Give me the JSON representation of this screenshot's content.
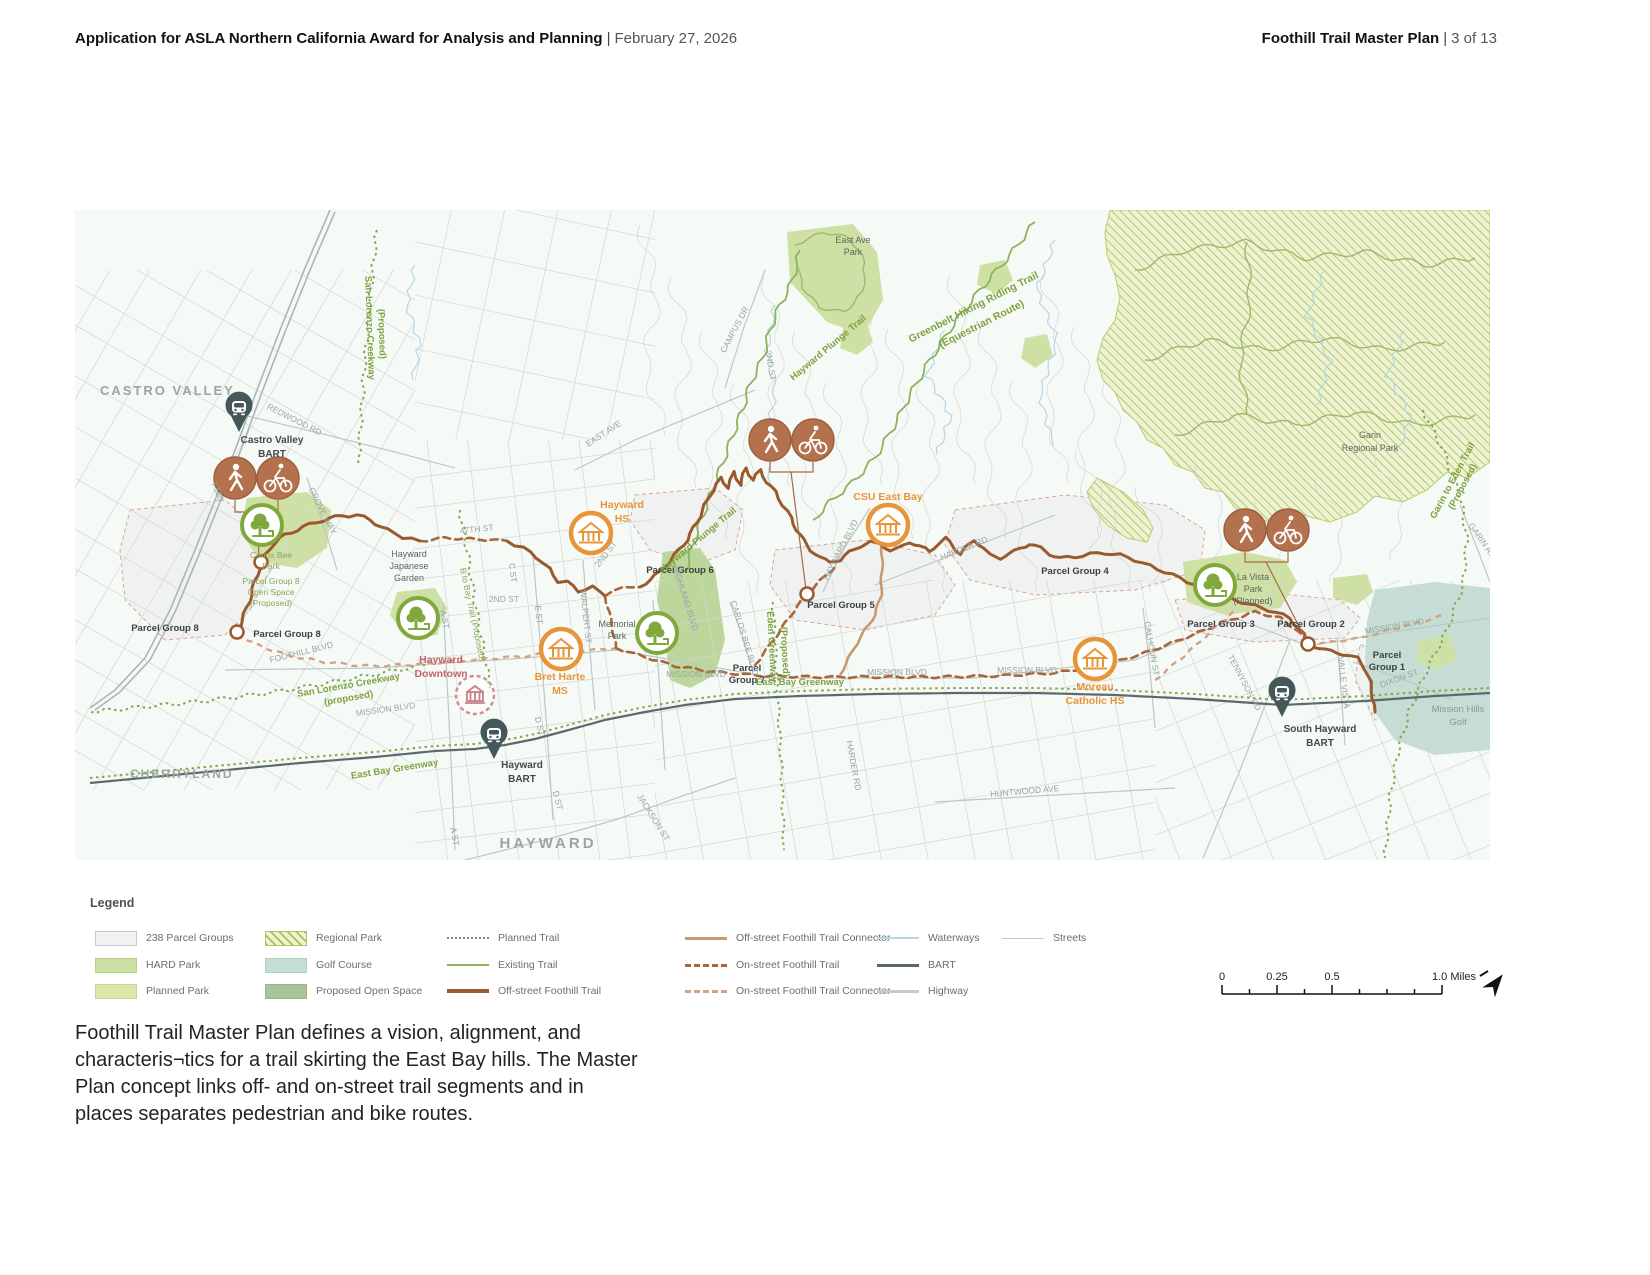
{
  "header": {
    "left": {
      "title": "Application for ASLA Northern California Award for Analysis and Planning",
      "sep": "|",
      "date": "February 27, 2026"
    },
    "right": {
      "title": "Foothill Trail Master Plan",
      "sep": "|",
      "page": "3 of 13"
    }
  },
  "caption": {
    "lines": [
      "Foothill Trail Master Plan defines a vision, alignment, and",
      "characteris¬tics for a trail skirting the East Bay hills. The Master",
      "Plan concept links off- and on-street trail segments and in",
      "places separates pedestrian and bike routes."
    ]
  },
  "legend": {
    "title": "Legend",
    "items": [
      {
        "label": "238 Parcel Groups",
        "kind": "swatch",
        "cls": "sw-parcel",
        "col": 0,
        "row": 0
      },
      {
        "label": "HARD Park",
        "kind": "swatch",
        "cls": "sw-hard",
        "col": 0,
        "row": 1
      },
      {
        "label": "Planned Park",
        "kind": "swatch",
        "cls": "sw-planned",
        "col": 0,
        "row": 2
      },
      {
        "label": "Regional Park",
        "kind": "swatch",
        "cls": "sw-regional",
        "col": 1,
        "row": 0
      },
      {
        "label": "Golf Course",
        "kind": "swatch",
        "cls": "sw-golf",
        "col": 1,
        "row": 1
      },
      {
        "label": "Proposed Open Space",
        "kind": "swatch",
        "cls": "sw-openspace",
        "col": 1,
        "row": 2
      },
      {
        "label": "Planned Trail",
        "kind": "line",
        "cls": "ln-planned",
        "col": 2,
        "row": 0
      },
      {
        "label": "Existing Trail",
        "kind": "line",
        "cls": "ln-existing",
        "col": 2,
        "row": 1
      },
      {
        "label": "Off-street Foothill Trail",
        "kind": "line",
        "cls": "ln-offstreet",
        "col": 2,
        "row": 2
      },
      {
        "label": "Off-street Foothill Trail Connector",
        "kind": "line",
        "cls": "ln-offconn",
        "col": 3,
        "row": 0
      },
      {
        "label": "On-street Foothill Trail",
        "kind": "line",
        "cls": "ln-onstreet",
        "col": 3,
        "row": 1
      },
      {
        "label": "On-street Foothill Trail Connector",
        "kind": "line",
        "cls": "ln-onconn",
        "col": 3,
        "row": 2
      },
      {
        "label": "Waterways",
        "kind": "line",
        "cls": "ln-water",
        "col": 4,
        "row": 0
      },
      {
        "label": "BART",
        "kind": "line",
        "cls": "ln-bart",
        "col": 4,
        "row": 1
      },
      {
        "label": "Highway",
        "kind": "line",
        "cls": "ln-highway",
        "col": 4,
        "row": 2
      },
      {
        "label": "Streets",
        "kind": "line",
        "cls": "ln-streets",
        "col": 5,
        "row": 0
      }
    ]
  },
  "scalebar": {
    "ticks": [
      "0",
      "0.25",
      "0.5"
    ],
    "end": "1.0 Miles"
  },
  "map": {
    "colors": {
      "trail_offstreet": "#9a5a2d",
      "trail_onstreet": "#aa663a",
      "connector": "#c9996e",
      "existing_trail": "#8db25c",
      "hard_park": "#cfe0a5",
      "golf": "#c5ddd5",
      "bart": "#5a6a6c",
      "school": "#e8953a",
      "tree": "#7fa83d",
      "pedbike": "#b3714e"
    },
    "labels": [
      {
        "t": "CASTRO VALLEY",
        "x": 25,
        "y": 185,
        "c": "city",
        "ls": 2,
        "a": "start"
      },
      {
        "t": "CHERRYLAND",
        "x": 55,
        "y": 568,
        "c": "city",
        "s": 12,
        "ls": 2,
        "a": "start"
      },
      {
        "t": "HAYWARD",
        "x": 473,
        "y": 638,
        "c": "city",
        "s": 15,
        "ls": 3
      },
      {
        "t": "Castro Valley",
        "x": 197,
        "y": 233,
        "c": "poi"
      },
      {
        "t": "BART",
        "x": 197,
        "y": 247,
        "c": "poi"
      },
      {
        "t": "Hayward",
        "x": 447,
        "y": 558,
        "c": "poi"
      },
      {
        "t": "BART",
        "x": 447,
        "y": 572,
        "c": "poi"
      },
      {
        "t": "South Hayward",
        "x": 1245,
        "y": 522,
        "c": "poi"
      },
      {
        "t": "BART",
        "x": 1245,
        "y": 536,
        "c": "poi"
      },
      {
        "t": "Hayward",
        "x": 366,
        "y": 453,
        "c": "red"
      },
      {
        "t": "Downtown",
        "x": 366,
        "y": 467,
        "c": "red"
      },
      {
        "t": "Hayward",
        "x": 547,
        "y": 298,
        "c": "org"
      },
      {
        "t": "HS",
        "x": 547,
        "y": 312,
        "c": "org"
      },
      {
        "t": "Bret Harte",
        "x": 485,
        "y": 470,
        "c": "org"
      },
      {
        "t": "MS",
        "x": 485,
        "y": 484,
        "c": "org"
      },
      {
        "t": "CSU East Bay",
        "x": 813,
        "y": 290,
        "c": "org"
      },
      {
        "t": "Moreau",
        "x": 1020,
        "y": 480,
        "c": "org"
      },
      {
        "t": "Catholic HS",
        "x": 1020,
        "y": 494,
        "c": "org"
      },
      {
        "t": "Hayward",
        "x": 334,
        "y": 347,
        "c": "pk"
      },
      {
        "t": "Japanese",
        "x": 334,
        "y": 359,
        "c": "pk"
      },
      {
        "t": "Garden",
        "x": 334,
        "y": 371,
        "c": "pk"
      },
      {
        "t": "Memorial",
        "x": 542,
        "y": 417,
        "c": "pk"
      },
      {
        "t": "Park",
        "x": 542,
        "y": 429,
        "c": "pk"
      },
      {
        "t": "La Vista",
        "x": 1178,
        "y": 370,
        "c": "pk"
      },
      {
        "t": "Park",
        "x": 1178,
        "y": 382,
        "c": "pk"
      },
      {
        "t": "(Planned)",
        "x": 1178,
        "y": 394,
        "c": "pk"
      },
      {
        "t": "East Ave",
        "x": 778,
        "y": 33,
        "c": "pk"
      },
      {
        "t": "Park",
        "x": 778,
        "y": 45,
        "c": "pk"
      },
      {
        "t": "Garin",
        "x": 1295,
        "y": 228,
        "c": "pk"
      },
      {
        "t": "Regional Park",
        "x": 1295,
        "y": 241,
        "c": "pk"
      },
      {
        "t": "Mission Hills",
        "x": 1383,
        "y": 502,
        "c": "golf"
      },
      {
        "t": "Golf",
        "x": 1383,
        "y": 515,
        "c": "golf"
      },
      {
        "t": "Carlos Bee",
        "x": 196,
        "y": 348,
        "c": "grn2"
      },
      {
        "t": "Park",
        "x": 196,
        "y": 359,
        "c": "grn2"
      },
      {
        "t": "Parcel Group 8",
        "x": 196,
        "y": 374,
        "c": "grn2"
      },
      {
        "t": "Open Space",
        "x": 196,
        "y": 385,
        "c": "grn2"
      },
      {
        "t": "(Proposed)",
        "x": 196,
        "y": 396,
        "c": "grn2"
      },
      {
        "t": "Parcel Group 8",
        "x": 90,
        "y": 421,
        "c": "pg"
      },
      {
        "t": "Parcel Group 8",
        "x": 212,
        "y": 427,
        "c": "pg"
      },
      {
        "t": "Parcel",
        "x": 672,
        "y": 461,
        "c": "pg"
      },
      {
        "t": "Group 7",
        "x": 672,
        "y": 473,
        "c": "pg"
      },
      {
        "t": "Parcel Group 6",
        "x": 605,
        "y": 363,
        "c": "pg"
      },
      {
        "t": "Parcel Group 5",
        "x": 766,
        "y": 398,
        "c": "pg"
      },
      {
        "t": "Parcel Group 4",
        "x": 1000,
        "y": 364,
        "c": "pg"
      },
      {
        "t": "Parcel Group 3",
        "x": 1146,
        "y": 417,
        "c": "pg"
      },
      {
        "t": "Parcel Group 2",
        "x": 1236,
        "y": 417,
        "c": "pg"
      },
      {
        "t": "Parcel",
        "x": 1312,
        "y": 448,
        "c": "pg"
      },
      {
        "t": "Group 1",
        "x": 1312,
        "y": 460,
        "c": "pg"
      },
      {
        "t": "REDWOOD RD",
        "x": 218,
        "y": 212,
        "r": 27
      },
      {
        "t": "GROVE WAY",
        "x": 245,
        "y": 302,
        "r": 63
      },
      {
        "t": "I-580",
        "x": 140,
        "y": 283,
        "r": 68
      },
      {
        "t": "47TH ST",
        "x": 402,
        "y": 322,
        "r": -6
      },
      {
        "t": "A ST",
        "x": 367,
        "y": 410,
        "r": 80
      },
      {
        "t": "A ST",
        "x": 377,
        "y": 627,
        "r": 80
      },
      {
        "t": "2ND ST",
        "x": 429,
        "y": 392
      },
      {
        "t": "2ND ST",
        "x": 533,
        "y": 346,
        "r": -52
      },
      {
        "t": "2ND ST",
        "x": 693,
        "y": 156,
        "r": 80
      },
      {
        "t": "C ST",
        "x": 435,
        "y": 363,
        "r": 83
      },
      {
        "t": "E ST",
        "x": 461,
        "y": 405,
        "r": 85
      },
      {
        "t": "WALPERT ST",
        "x": 508,
        "y": 407,
        "r": 84
      },
      {
        "t": "D ST",
        "x": 462,
        "y": 517,
        "r": 76
      },
      {
        "t": "D ST",
        "x": 480,
        "y": 591,
        "r": 76
      },
      {
        "t": "JACKSON ST",
        "x": 576,
        "y": 609,
        "r": 58
      },
      {
        "t": "FOOTHILL BLVD",
        "x": 227,
        "y": 445,
        "r": -14
      },
      {
        "t": "MISSION BLVD",
        "x": 311,
        "y": 502,
        "r": -8
      },
      {
        "t": "MISSION BLVD",
        "x": 621,
        "y": 467
      },
      {
        "t": "MISSION BLVD",
        "x": 822,
        "y": 465
      },
      {
        "t": "MISSION BLVD",
        "x": 952,
        "y": 463
      },
      {
        "t": "MISSION BLVD",
        "x": 1320,
        "y": 419,
        "r": -10
      },
      {
        "t": "EAST AVE",
        "x": 530,
        "y": 226,
        "r": -33
      },
      {
        "t": "CAMPUS DR",
        "x": 662,
        "y": 121,
        "r": -62
      },
      {
        "t": "HAYWARD BLVD",
        "x": 768,
        "y": 341,
        "r": -63
      },
      {
        "t": "HARDER RD",
        "x": 890,
        "y": 341,
        "r": -22
      },
      {
        "t": "HARDER RD",
        "x": 776,
        "y": 556,
        "r": 80
      },
      {
        "t": "HIGHLAND BLVD",
        "x": 608,
        "y": 389,
        "r": 72
      },
      {
        "t": "CARLOS BEE BLVD",
        "x": 667,
        "y": 429,
        "r": 73
      },
      {
        "t": "CALHOUN ST",
        "x": 1074,
        "y": 439,
        "r": 80
      },
      {
        "t": "TENNYSON RD",
        "x": 1167,
        "y": 474,
        "r": 62
      },
      {
        "t": "VALLE VISTA",
        "x": 1266,
        "y": 473,
        "r": 83
      },
      {
        "t": "DIXON ST",
        "x": 1325,
        "y": 471,
        "r": -20
      },
      {
        "t": "GARIN AVE",
        "x": 1406,
        "y": 334,
        "r": 55
      },
      {
        "t": "HUNTWOOD AVE",
        "x": 950,
        "y": 584,
        "r": -5
      },
      {
        "t": "Hayward Plunge Trail",
        "x": 755,
        "y": 140,
        "r": -40,
        "c": "grn"
      },
      {
        "t": "Hayward Plunge Trail",
        "x": 625,
        "y": 332,
        "r": -40,
        "c": "grn"
      },
      {
        "t": "Greenbelt Hiking Riding Trail",
        "x": 900,
        "y": 100,
        "r": -27,
        "c": "grn",
        "s": 10.5
      },
      {
        "t": "(Equestrian Route)",
        "x": 908,
        "y": 117,
        "r": -27,
        "c": "grn",
        "s": 10.5
      },
      {
        "t": "San Lorenzo Creekway",
        "x": 292,
        "y": 118,
        "r": 88,
        "c": "grn"
      },
      {
        "t": "(Proposed)",
        "x": 304,
        "y": 124,
        "r": 88,
        "c": "grn"
      },
      {
        "t": "San Lorenzo Creekway",
        "x": 274,
        "y": 478,
        "r": -10,
        "c": "grn"
      },
      {
        "t": "(proposed)",
        "x": 274,
        "y": 491,
        "r": -10,
        "c": "grn"
      },
      {
        "t": "East Bay Greenway",
        "x": 320,
        "y": 562,
        "r": -9,
        "c": "grn"
      },
      {
        "t": "East Bay Greenway",
        "x": 725,
        "y": 475,
        "c": "grn"
      },
      {
        "t": "Eden Greenway",
        "x": 694,
        "y": 437,
        "r": 87,
        "c": "grn"
      },
      {
        "t": "(Proposed)",
        "x": 707,
        "y": 442,
        "r": 87,
        "c": "grn"
      },
      {
        "t": "B to Bay Trail (Proposed)",
        "x": 395,
        "y": 405,
        "r": 78,
        "c": "grn2"
      },
      {
        "t": "Garin to Eden Trail",
        "x": 1380,
        "y": 272,
        "r": -62,
        "c": "grn"
      },
      {
        "t": "(Proposed)",
        "x": 1390,
        "y": 278,
        "r": -62,
        "c": "grn"
      }
    ],
    "icons": [
      {
        "k": "ped",
        "x": 160,
        "y": 268
      },
      {
        "k": "bike",
        "x": 203,
        "y": 268
      },
      {
        "k": "ped",
        "x": 695,
        "y": 230
      },
      {
        "k": "bike",
        "x": 738,
        "y": 230
      },
      {
        "k": "ped",
        "x": 1170,
        "y": 320
      },
      {
        "k": "bike",
        "x": 1213,
        "y": 320
      },
      {
        "k": "tree",
        "x": 187,
        "y": 315
      },
      {
        "k": "tree",
        "x": 343,
        "y": 408
      },
      {
        "k": "tree",
        "x": 582,
        "y": 423
      },
      {
        "k": "tree",
        "x": 1140,
        "y": 375
      },
      {
        "k": "school",
        "x": 516,
        "y": 323
      },
      {
        "k": "school",
        "x": 486,
        "y": 439
      },
      {
        "k": "school",
        "x": 813,
        "y": 315
      },
      {
        "k": "school",
        "x": 1020,
        "y": 449
      },
      {
        "k": "bart",
        "x": 164,
        "y": 205
      },
      {
        "k": "bart",
        "x": 419,
        "y": 532
      },
      {
        "k": "bart",
        "x": 1207,
        "y": 490
      },
      {
        "k": "downtown",
        "x": 400,
        "y": 485
      },
      {
        "k": "node",
        "x": 162,
        "y": 422
      },
      {
        "k": "node",
        "x": 186,
        "y": 352
      },
      {
        "k": "node",
        "x": 732,
        "y": 384
      },
      {
        "k": "node",
        "x": 1233,
        "y": 434
      }
    ]
  }
}
